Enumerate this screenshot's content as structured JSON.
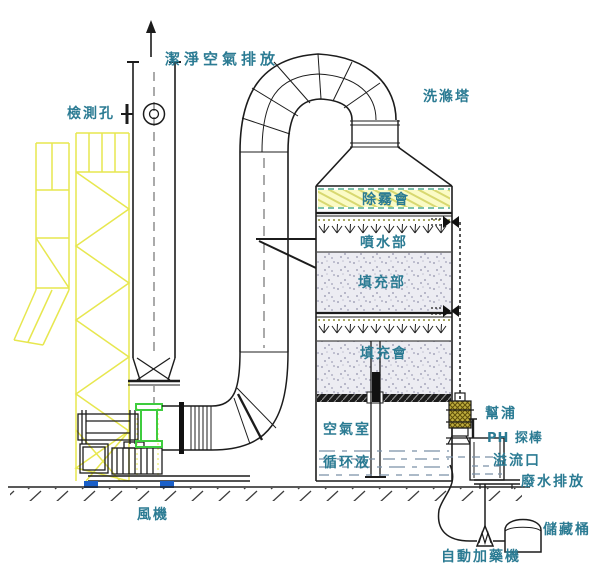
{
  "diagram": {
    "title": "洗滌塔",
    "labels": {
      "clean_air_exhaust": "潔淨空氣排放",
      "inspection_hole": "檢測孔",
      "scrubber_tower": "洗滌塔",
      "demister_layer": "除霧會",
      "spray_section": "噴水部",
      "packing_section_1": "填充部",
      "packing_section_2": "填充會",
      "air_chamber": "空氣室",
      "circulating_liquid": "循环液",
      "pump": "幫浦",
      "ph_probe": "PH 探棒",
      "overflow_port": "溢流口",
      "wastewater_discharge": "廢水排放",
      "storage_tank": "儲藏桶",
      "auto_dosing_machine": "自動加藥機",
      "fan": "風機"
    },
    "colors": {
      "label_text": "#2b7b93",
      "structure_yellow": "#e7e74f",
      "demister_band": "#fbfbc6",
      "flex_connector_green": "#3ecc3e",
      "base_pad_blue": "#1a5fc8",
      "liquid_dash": "#7b90a6",
      "line": "#1c1c1c"
    }
  }
}
